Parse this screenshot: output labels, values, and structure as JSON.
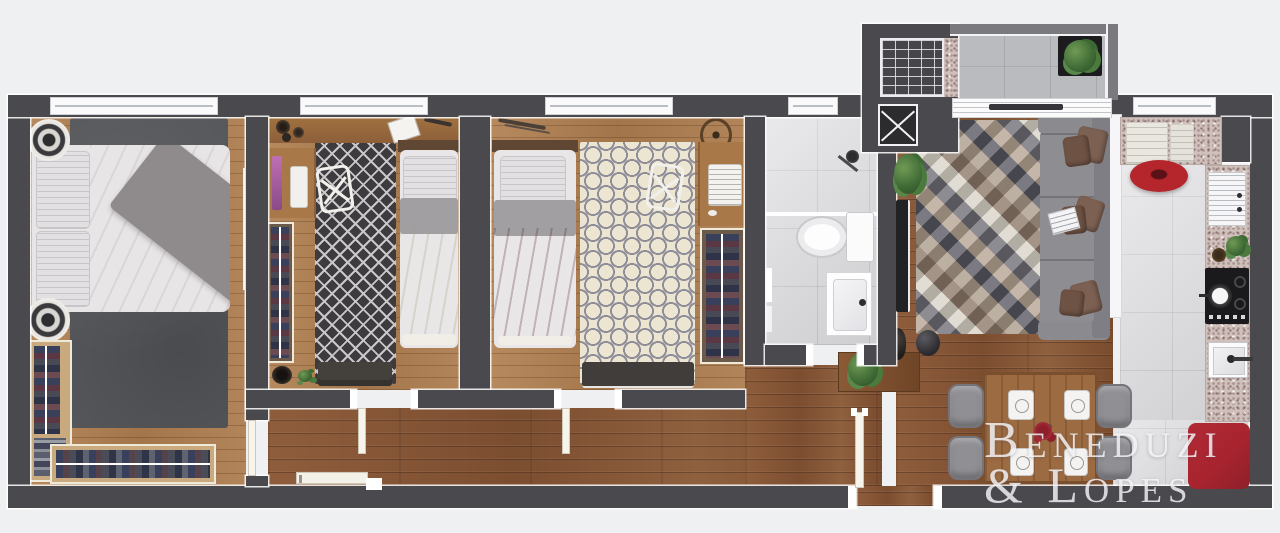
{
  "watermark": {
    "line1": "Beneduzi",
    "line2": "& Lopes"
  },
  "palette": {
    "background": "#eef0f2",
    "wall": "#4a4a4e",
    "wood_bedroom": "#b0835a",
    "wood_hall": "#8a5a3a",
    "tile": "#d8d8db",
    "terrace_floor": "#b9bbbf",
    "granite": "#cfc0bb",
    "rug_master": "#57585c",
    "rug_bedroom2": "#3e3b3e",
    "rug_bedroom3": "#ece5d2",
    "red_rug": "#a8242e",
    "red_appliance": "#b5252c",
    "duvet_red": "#a4525e",
    "duvet_cream": "#e9e1ca",
    "sofa": "#8b8b8f",
    "cushion_brown": "#7c6052",
    "table_wood": "#9c6b42",
    "chair_gray": "#909094",
    "plant_green": "#4f7a42"
  },
  "rooms": [
    {
      "id": "master-bedroom",
      "furniture": [
        "double-bed",
        "area-rug",
        "pouf",
        "pouf",
        "l-shaped-closet",
        "wall-tv"
      ]
    },
    {
      "id": "bedroom-2",
      "furniture": [
        "single-bed-cream",
        "desk-with-monitor",
        "desk-chair",
        "diamond-rug",
        "closet",
        "bench"
      ]
    },
    {
      "id": "bedroom-3",
      "furniture": [
        "single-bed-red",
        "desk-with-laptop",
        "desk-chair",
        "quatrefoil-rug",
        "closet",
        "bench"
      ]
    },
    {
      "id": "bathroom",
      "furniture": [
        "shower",
        "toilet",
        "vanity-sink"
      ]
    },
    {
      "id": "hallway",
      "furniture": [
        "console-table",
        "plant",
        "entry-door"
      ]
    },
    {
      "id": "living-room",
      "furniture": [
        "sofa",
        "geometric-rug",
        "wall-tv",
        "plant",
        "vase"
      ]
    },
    {
      "id": "kitchen",
      "furniture": [
        "countertop",
        "dish-rack",
        "cooktop",
        "sink",
        "towels",
        "red-mixer",
        "red-rug"
      ]
    },
    {
      "id": "dining",
      "furniture": [
        "table",
        "chair",
        "chair",
        "chair",
        "chair",
        "place-settings",
        "flower-centerpiece"
      ]
    },
    {
      "id": "terrace",
      "furniture": [
        "planter-box",
        "sliding-door"
      ]
    },
    {
      "id": "service-core",
      "furniture": [
        "staircase",
        "shaft"
      ]
    }
  ]
}
